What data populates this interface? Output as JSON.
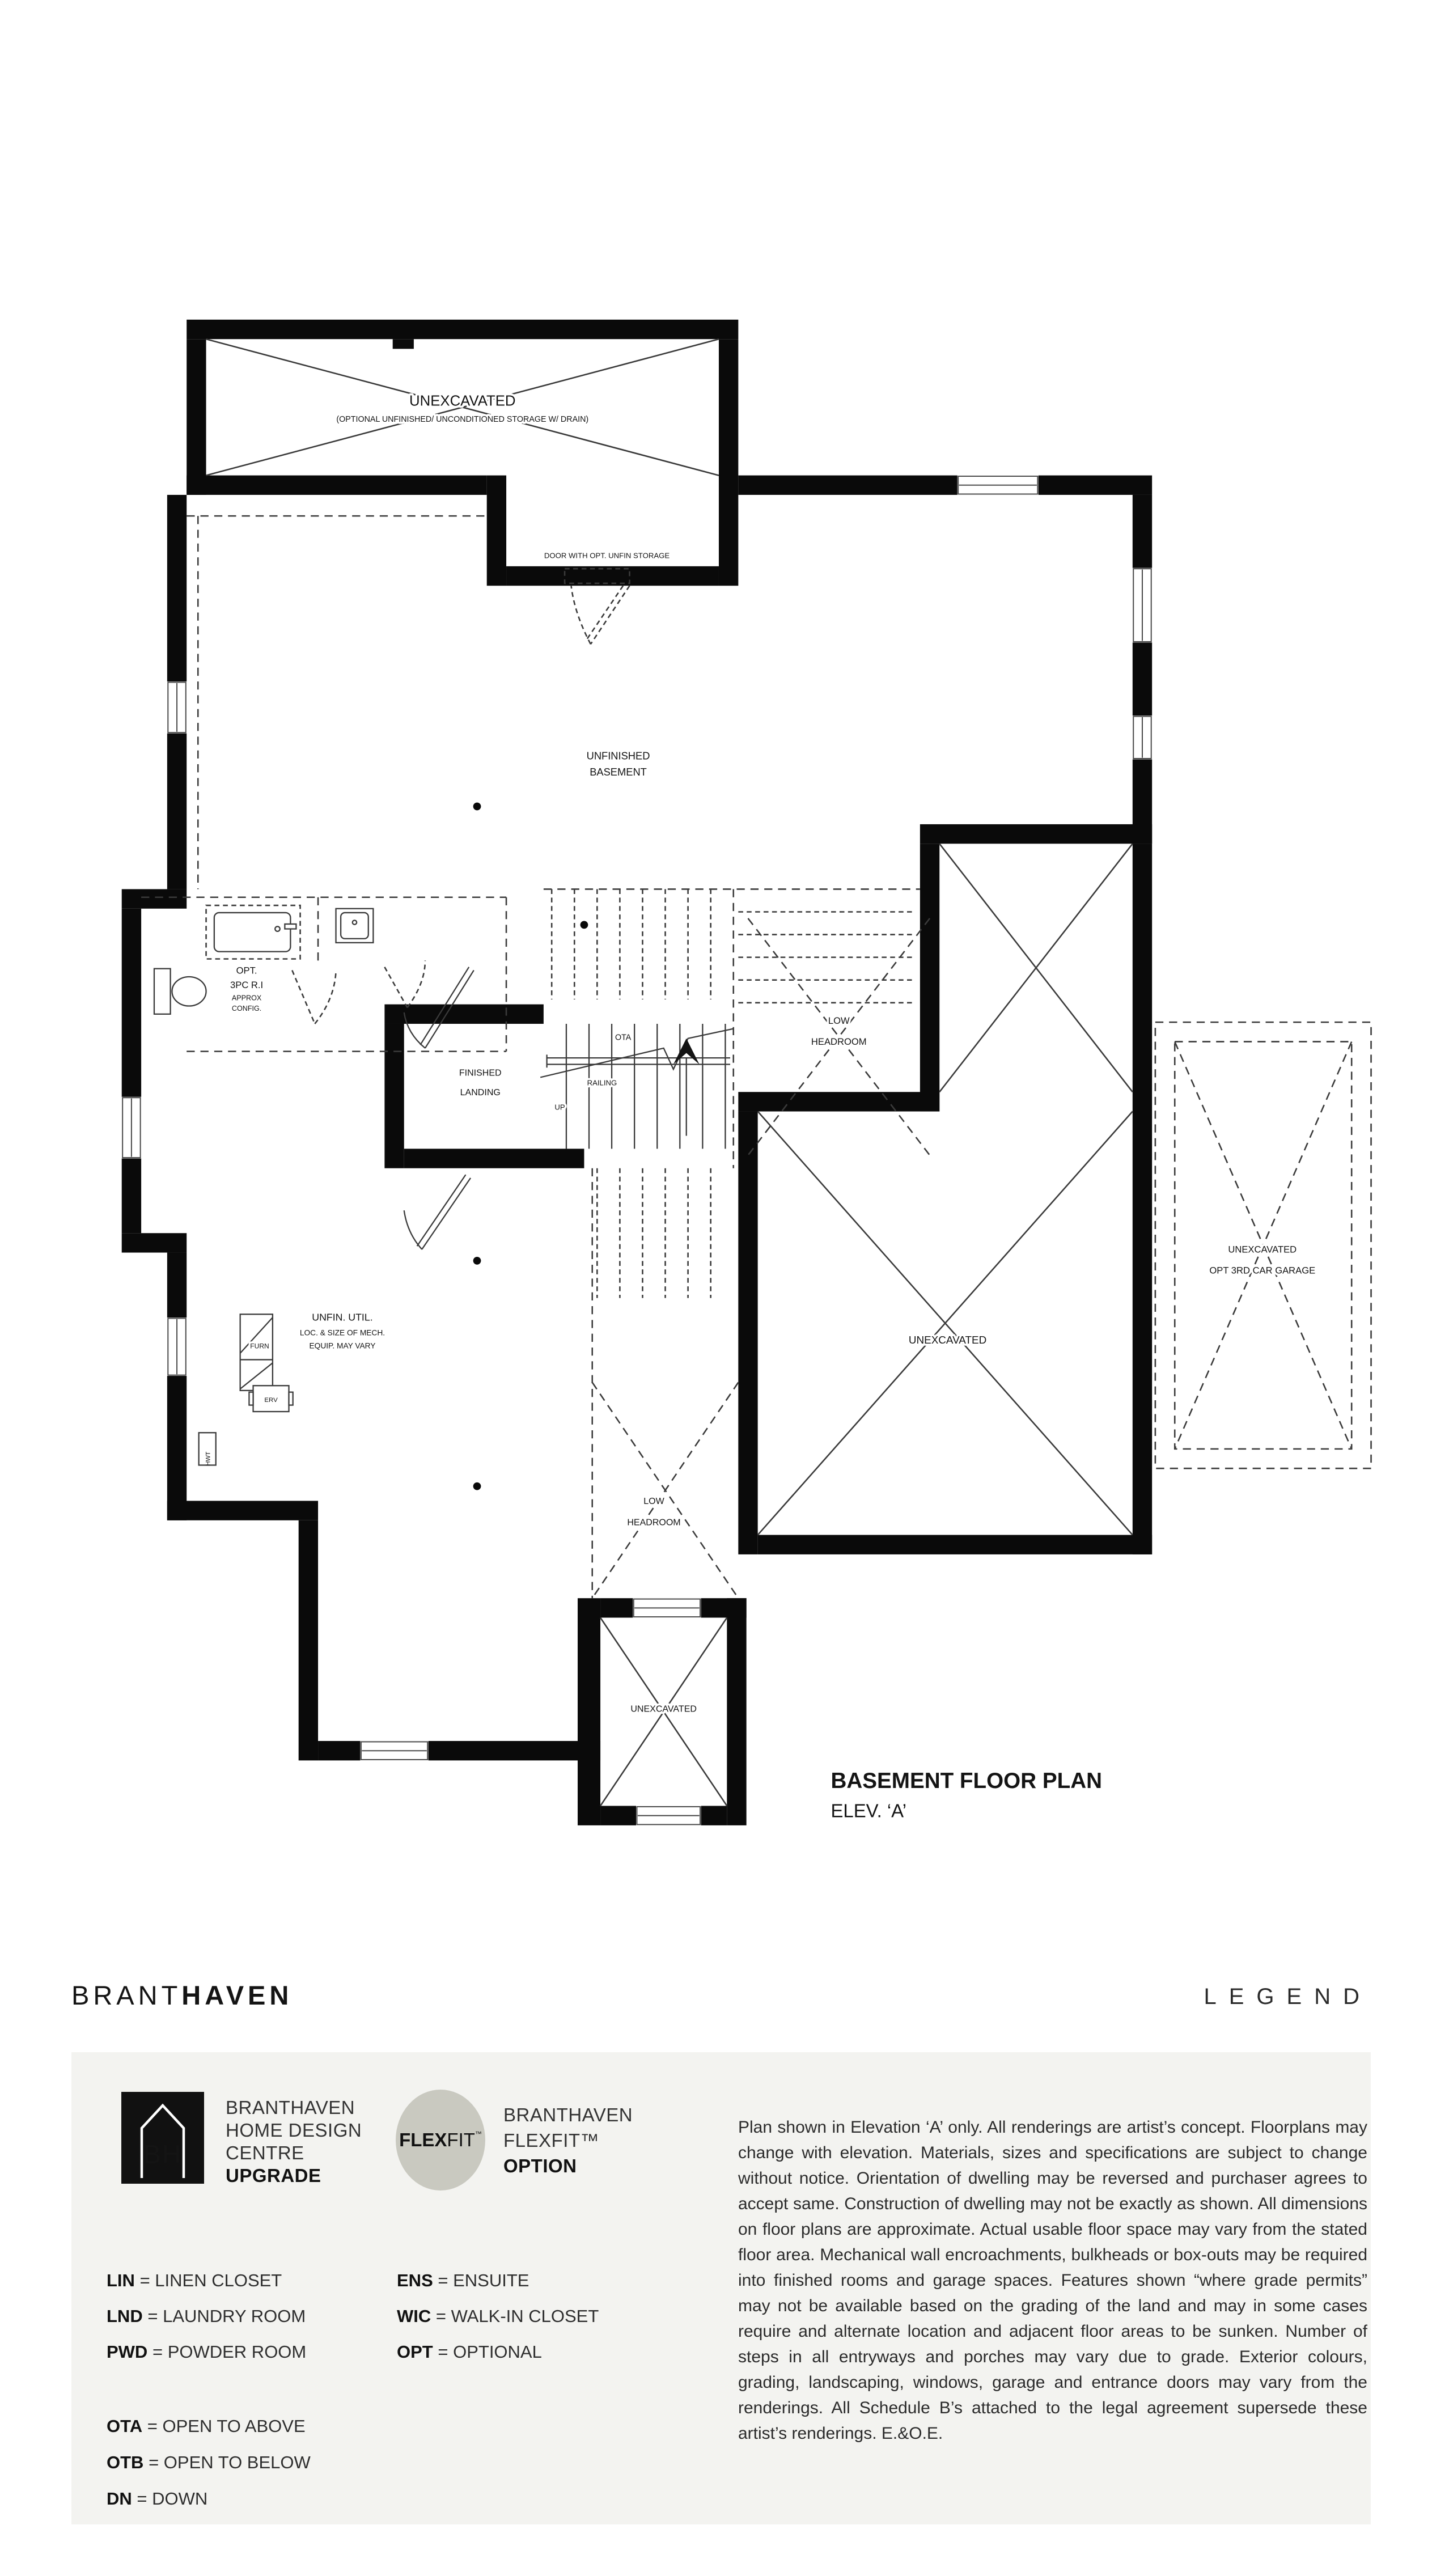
{
  "plan": {
    "title": "BASEMENT FLOOR PLAN",
    "subtitle": "ELEV. ‘A’",
    "labels": {
      "storage_unexcavated": "UNEXCAVATED",
      "storage_note": "(OPTIONAL UNFINISHED/ UNCONDITIONED STORAGE W/ DRAIN)",
      "door_note": "DOOR WITH OPT. UNFIN STORAGE",
      "unfinished_1": "UNFINISHED",
      "unfinished_2": "BASEMENT",
      "opt_bath_1": "OPT.",
      "opt_bath_2": "3PC R.I",
      "opt_bath_3": "APPROX",
      "opt_bath_4": "CONFIG.",
      "landing_1": "FINISHED",
      "landing_2": "LANDING",
      "ota": "OTA",
      "railing": "RAILING",
      "up": "UP",
      "low_headroom_1": "LOW",
      "low_headroom_2": "HEADROOM",
      "unexcavated_main": "UNEXCAVATED",
      "garage_1": "UNEXCAVATED",
      "garage_2": "OPT 3RD CAR GARAGE",
      "util_1": "UNFIN. UTIL.",
      "util_2": "LOC. & SIZE OF MECH.",
      "util_3": "EQUIP. MAY VARY",
      "furn": "FURN",
      "erv": "ERV",
      "hwt": "HWT",
      "unexcavated_small": "UNEXCAVATED",
      "low_headroom2_1": "LOW",
      "low_headroom2_2": "HEADROOM"
    }
  },
  "header": {
    "brand_light": "BRANT",
    "brand_bold": "HAVEN",
    "legend_title": "LEGEND"
  },
  "legend": {
    "separator": "=",
    "bh_logo_text": "BH",
    "upgrade": {
      "line1": "BRANTHAVEN",
      "line2": "HOME DESIGN",
      "line3": "CENTRE",
      "line4": "UPGRADE"
    },
    "flexfit_badge": {
      "bold": "FLEX",
      "light": "FIT",
      "tm": "™"
    },
    "flexfit": {
      "line1": "BRANTHAVEN",
      "line2": "FLEXFIT™",
      "line3": "OPTION"
    },
    "abbreviations": [
      {
        "abbr": "LIN",
        "meaning": "LINEN CLOSET"
      },
      {
        "abbr": "LND",
        "meaning": "LAUNDRY ROOM"
      },
      {
        "abbr": "PWD",
        "meaning": "POWDER ROOM"
      },
      {
        "abbr": "ENS",
        "meaning": "ENSUITE"
      },
      {
        "abbr": "WIC",
        "meaning": "WALK-IN CLOSET"
      },
      {
        "abbr": "OPT",
        "meaning": "OPTIONAL"
      },
      {
        "abbr": "OTA",
        "meaning": "OPEN TO ABOVE"
      },
      {
        "abbr": "OTB",
        "meaning": "OPEN TO BELOW"
      },
      {
        "abbr": "DN",
        "meaning": "DOWN"
      }
    ],
    "disclaimer": "Plan shown in Elevation ‘A’ only. All renderings are artist’s concept. Floorplans may change with elevation. Materials, sizes and specifications are subject to change without notice. Orientation of dwelling may be reversed and purchaser agrees to accept same. Construction of dwelling may not be exactly as shown. All dimensions on floor plans are approximate. Actual usable floor space may vary from the stated floor area. Mechanical wall encroachments, bulkheads or box-outs may be required into finished rooms and garage spaces. Features shown “where grade permits” may not be available based on the grading of the land and may in some cases require and alternate location and adjacent floor areas to be sunken. Number of steps in all entryways and porches may vary due to grade. Exterior colours, grading, landscaping, windows, garage and entrance doors may vary from the renderings. All Schedule B’s attached to the legal agreement supersede these artist’s renderings. E.&O.E.",
    "colors": {
      "legend_bg": "#f3f3f0",
      "flexfit_circle": "#c9c9c0",
      "ink": "#1a1a1a"
    }
  }
}
